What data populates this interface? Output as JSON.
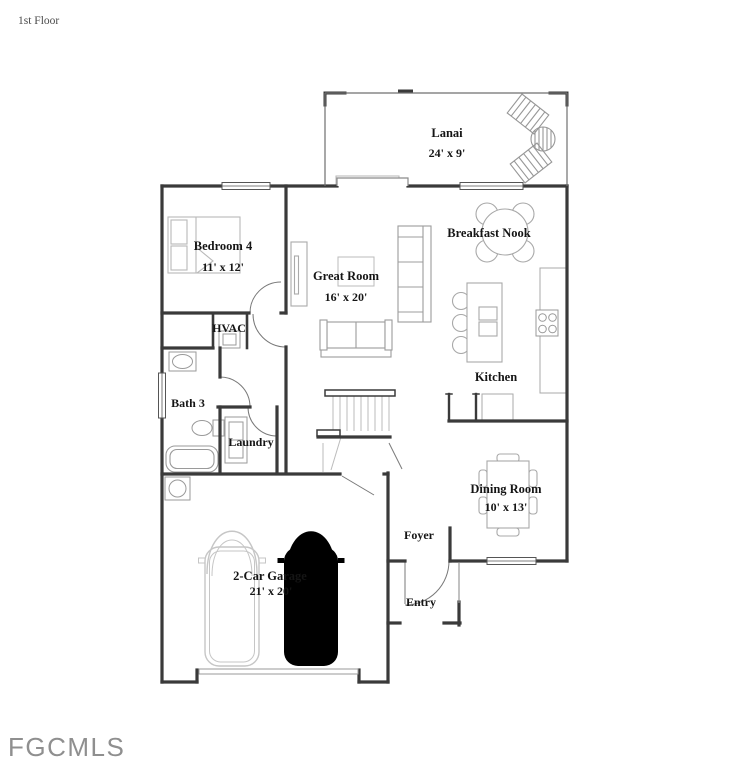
{
  "meta": {
    "floor_label": "1st Floor",
    "watermark": "FGCMLS"
  },
  "rooms": {
    "lanai": {
      "name": "Lanai",
      "dims": "24' x 9'"
    },
    "bedroom4": {
      "name": "Bedroom 4",
      "dims": "11' x 12'"
    },
    "great_room": {
      "name": "Great Room",
      "dims": "16' x 20'"
    },
    "breakfast": {
      "name": "Breakfast Nook"
    },
    "hvac": {
      "name": "HVAC"
    },
    "bath3": {
      "name": "Bath 3"
    },
    "kitchen": {
      "name": "Kitchen"
    },
    "laundry": {
      "name": "Laundry"
    },
    "dining": {
      "name": "Dining Room",
      "dims": "10' x 13'"
    },
    "foyer": {
      "name": "Foyer"
    },
    "entry": {
      "name": "Entry"
    },
    "garage": {
      "name": "2-Car Garage",
      "dims": "21' x 20'"
    }
  },
  "colors": {
    "wall": "#3a3a3a",
    "thin_line": "#777777",
    "furniture": "#aaaaaa",
    "light_furniture": "#c6c6c6",
    "label_text": "#151515",
    "watermark_text": "#8f8f8f",
    "background": "#ffffff"
  }
}
